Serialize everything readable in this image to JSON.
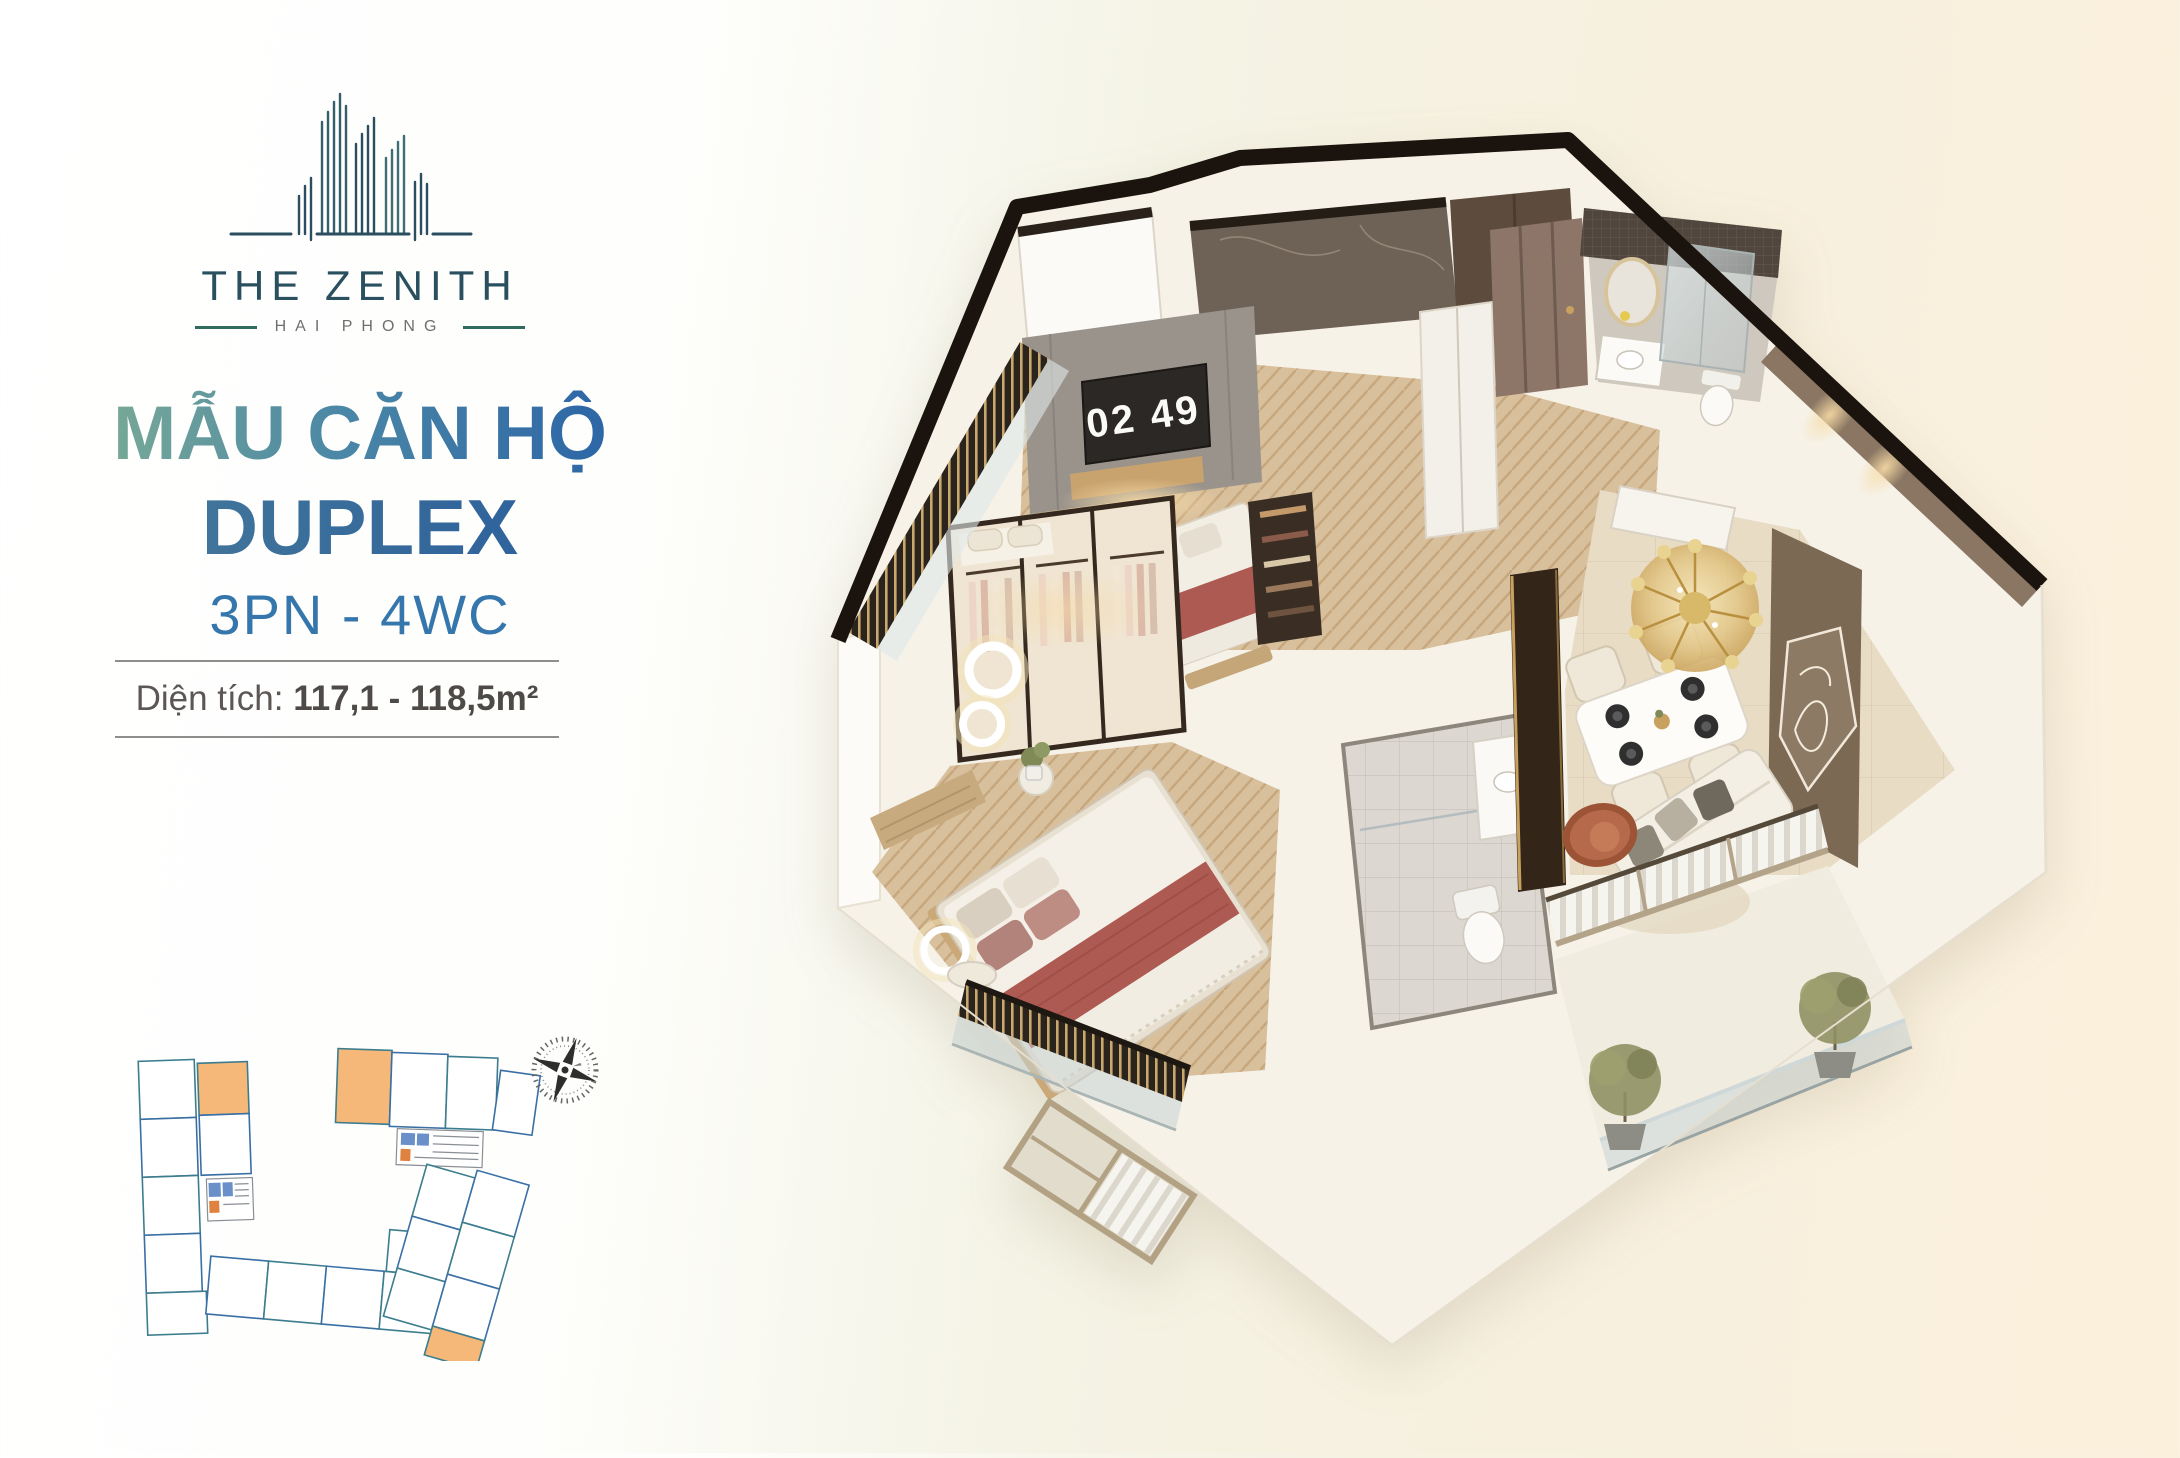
{
  "brand": {
    "name": "THE ZENITH",
    "location": "HAI PHONG"
  },
  "listing": {
    "title_line1": "MẪU CĂN HỘ",
    "title_line2": "DUPLEX",
    "subtitle": "3PN - 4WC",
    "area_label": "Diện tích:",
    "area_value": "117,1 - 118,5m²"
  },
  "floorplan": {
    "clock_display": "02 49"
  },
  "colors": {
    "brand_teal": "#2a4f5f",
    "accent_green": "#7bab91",
    "accent_blue": "#2a63a6",
    "subtitle_blue": "#3577ad",
    "highlight_orange": "#f5b878",
    "plan_outline_teal": "#3c7d8d",
    "plan_outline_blue": "#3a6fa6",
    "background_cream": "#f8f0de"
  }
}
